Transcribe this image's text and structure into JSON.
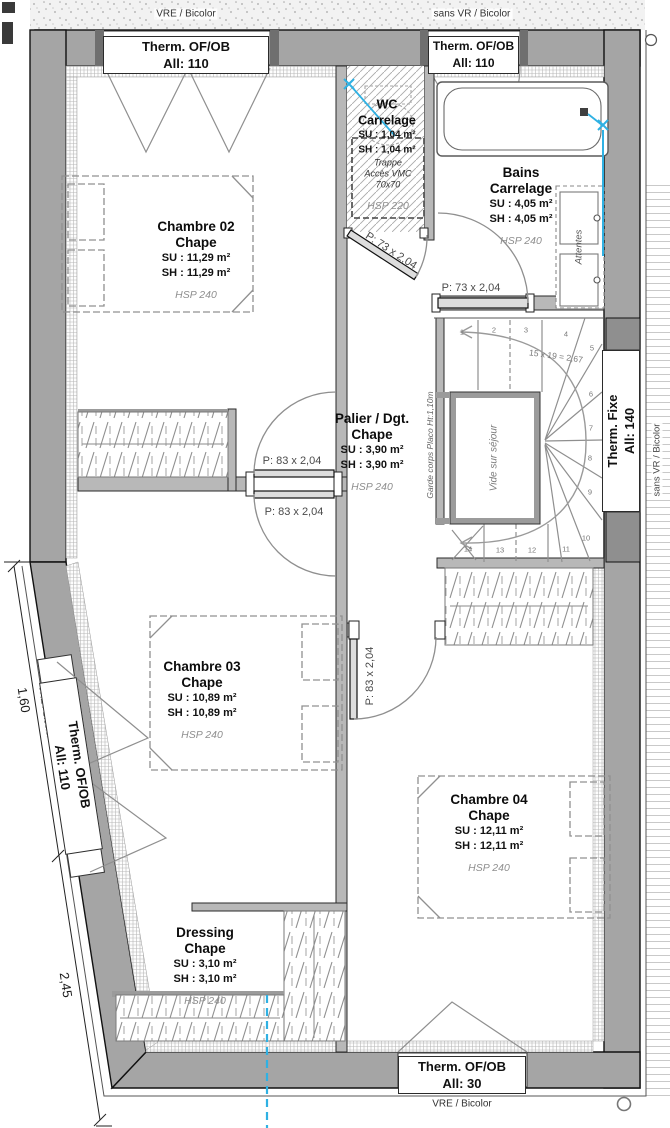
{
  "windows": [
    {
      "id": "top-left",
      "line1": "Therm. OF/OB",
      "line2": "All:  110",
      "outside": "VRE / Bicolor"
    },
    {
      "id": "top-right",
      "line1": "Therm. OF/OB",
      "line2": "All:  110",
      "outside": "sans VR / Bicolor"
    },
    {
      "id": "left",
      "line1": "Therm. OF/OB",
      "line2": "All:  110",
      "outside": "VRE / Bicolor"
    },
    {
      "id": "right",
      "line1": "Therm. Fixe",
      "line2": "All:  140",
      "outside": "sans VR / Bicolor"
    },
    {
      "id": "bottom",
      "line1": "Therm. OF/OB",
      "line2": "All:  30",
      "outside": "VRE / Bicolor"
    }
  ],
  "rooms": [
    {
      "id": "chambre02",
      "name": "Chambre 02",
      "finish": "Chape",
      "su": "SU : 11,29 m²",
      "sh": "SH : 11,29 m²",
      "hsp": "HSP 240"
    },
    {
      "id": "wc",
      "name": "WC",
      "finish": "Carrelage",
      "su": "SU : 1,04 m²",
      "sh": "SH : 1,04 m²",
      "hsp": "HSP 220"
    },
    {
      "id": "bains",
      "name": "Bains",
      "finish": "Carrelage",
      "su": "SU : 4,05 m²",
      "sh": "SH : 4,05 m²",
      "hsp": "HSP 240"
    },
    {
      "id": "palier",
      "name": "Palier / Dgt.",
      "finish": "Chape",
      "su": "SU : 3,90 m²",
      "sh": "SH : 3,90 m²",
      "hsp": "HSP 240"
    },
    {
      "id": "chambre03",
      "name": "Chambre 03",
      "finish": "Chape",
      "su": "SU : 10,89 m²",
      "sh": "SH : 10,89 m²",
      "hsp": "HSP 240"
    },
    {
      "id": "chambre04",
      "name": "Chambre 04",
      "finish": "Chape",
      "su": "SU : 12,11 m²",
      "sh": "SH : 12,11 m²",
      "hsp": "HSP 240"
    },
    {
      "id": "dressing",
      "name": "Dressing",
      "finish": "Chape",
      "su": "SU : 3,10 m²",
      "sh": "SH : 3,10 m²",
      "hsp": "HSP 240"
    }
  ],
  "wc_trap": {
    "line1": "Trappe",
    "line2": "Accès VMC",
    "line3": "70x70"
  },
  "doors": {
    "wc": "P: 73 x 2,04",
    "bains": "P: 73 x 2,04",
    "chambre02": "P: 83 x 2,04",
    "chambre03": "P: 83 x 2,04",
    "chambre04": "P: 83 x 2,04"
  },
  "stairs": {
    "formula": "15 x 19 = 2,67",
    "void": "Vide sur séjour",
    "guard": "Garde corps Placo Ht:1,10m",
    "steps": [
      "1",
      "2",
      "3",
      "4",
      "5",
      "6",
      "7",
      "8",
      "9",
      "10",
      "11",
      "12",
      "13",
      "14"
    ]
  },
  "bath": {
    "attentes": "Attentes"
  },
  "dimensions": {
    "d1": "1,60",
    "d2": "2,45"
  },
  "colors": {
    "wall": "#a5a5a5",
    "partition": "#b8b8b8",
    "plumbing_blue": "#2fb1e3",
    "line": "#1a1a1a"
  }
}
